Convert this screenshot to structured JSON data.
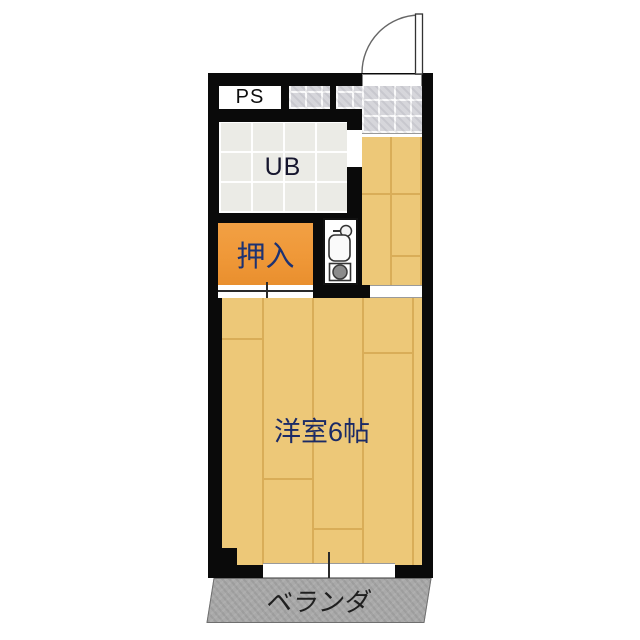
{
  "plan": {
    "type": "japanese-apartment-floor-plan",
    "rooms": {
      "pipe_space": {
        "label": "PS"
      },
      "unit_bath": {
        "label": "UB"
      },
      "closet": {
        "label": "押入"
      },
      "main_room": {
        "label": "洋室6帖"
      },
      "veranda": {
        "label": "ベランダ"
      }
    },
    "fixtures": [
      "entry-swing-door",
      "genkan-tile-floor",
      "kitchen-sink",
      "faucet",
      "stove-burner",
      "closet-sliding-door-track",
      "balcony-window"
    ],
    "colors": {
      "wall": "#0a0a0a",
      "wood_floor": "#edc878",
      "wood_seam": "#d9ad58",
      "closet_orange": "#ef9838",
      "tile_gray": "#d6d6db",
      "unit_bath_gray": "#ebebe6",
      "veranda_gray": "#a9a9a9",
      "label_navy": "#1d3272",
      "label_dark": "#1f1f1f"
    }
  }
}
